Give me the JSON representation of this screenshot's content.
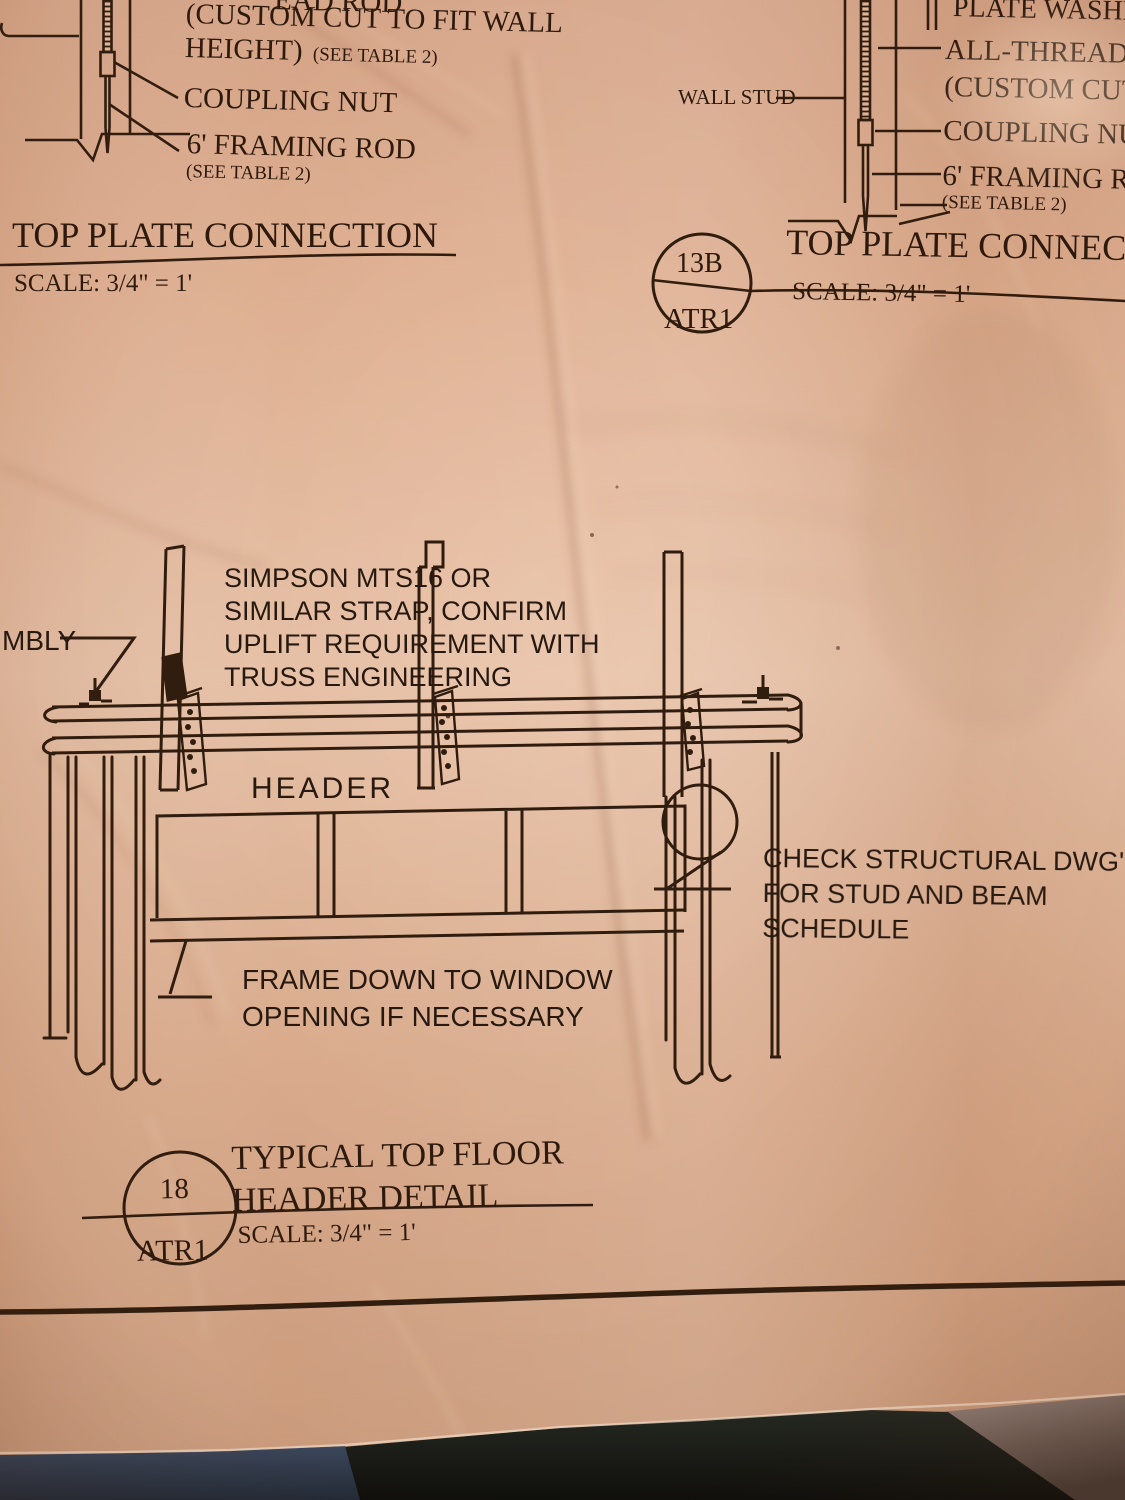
{
  "detail_13a": {
    "rod_label_fragment": "EAD ROD",
    "note_line1": "(CUSTOM CUT TO FIT WALL",
    "note_line2": "HEIGHT)",
    "note_see_table": "(SEE TABLE 2)",
    "coupling_nut_label": "COUPLING NUT",
    "framing_rod_label": "6' FRAMING ROD",
    "framing_rod_see_table": "(SEE TABLE 2)",
    "title": "TOP PLATE CONNECTION",
    "scale": "SCALE: 3/4\" = 1'"
  },
  "detail_13b": {
    "wall_stud_label": "WALL STUD",
    "plate_washer_label": "PLATE WASHE",
    "all_thread_label": "ALL-THREAD R",
    "custom_cut_label": "(CUSTOM CUT",
    "coupling_nut_label": "COUPLING NU",
    "framing_rod_label": "6' FRAMING R",
    "see_table_label": "(SEE TABLE 2)",
    "bubble_number": "13B",
    "bubble_sheet": "ATR1",
    "title": "TOP PLATE CONNECT",
    "scale": "SCALE: 3/4\" = 1'"
  },
  "detail_18": {
    "assembly_fragment": "MBLY",
    "strap_note": [
      "SIMPSON MTS16 OR",
      "SIMILAR STRAP, CONFIRM",
      "UPLIFT REQUIREMENT WITH",
      "TRUSS ENGINEERING"
    ],
    "header_label": "HEADER",
    "check_note": [
      "CHECK STRUCTURAL DWG'S",
      "FOR STUD AND BEAM",
      "SCHEDULE"
    ],
    "frame_note": [
      "FRAME DOWN TO WINDOW",
      "OPENING IF NECESSARY"
    ],
    "bubble_number": "18",
    "bubble_sheet": "ATR1",
    "title_line1": "TYPICAL TOP FLOOR",
    "title_line2": "HEADER DETAIL",
    "scale": "SCALE: 3/4\" = 1'"
  },
  "colors": {
    "paper": "#e4b99c",
    "ink": "#2d190d",
    "denim": "#33405a",
    "dark_floor": "#141713",
    "light_floor": "#94827c"
  }
}
